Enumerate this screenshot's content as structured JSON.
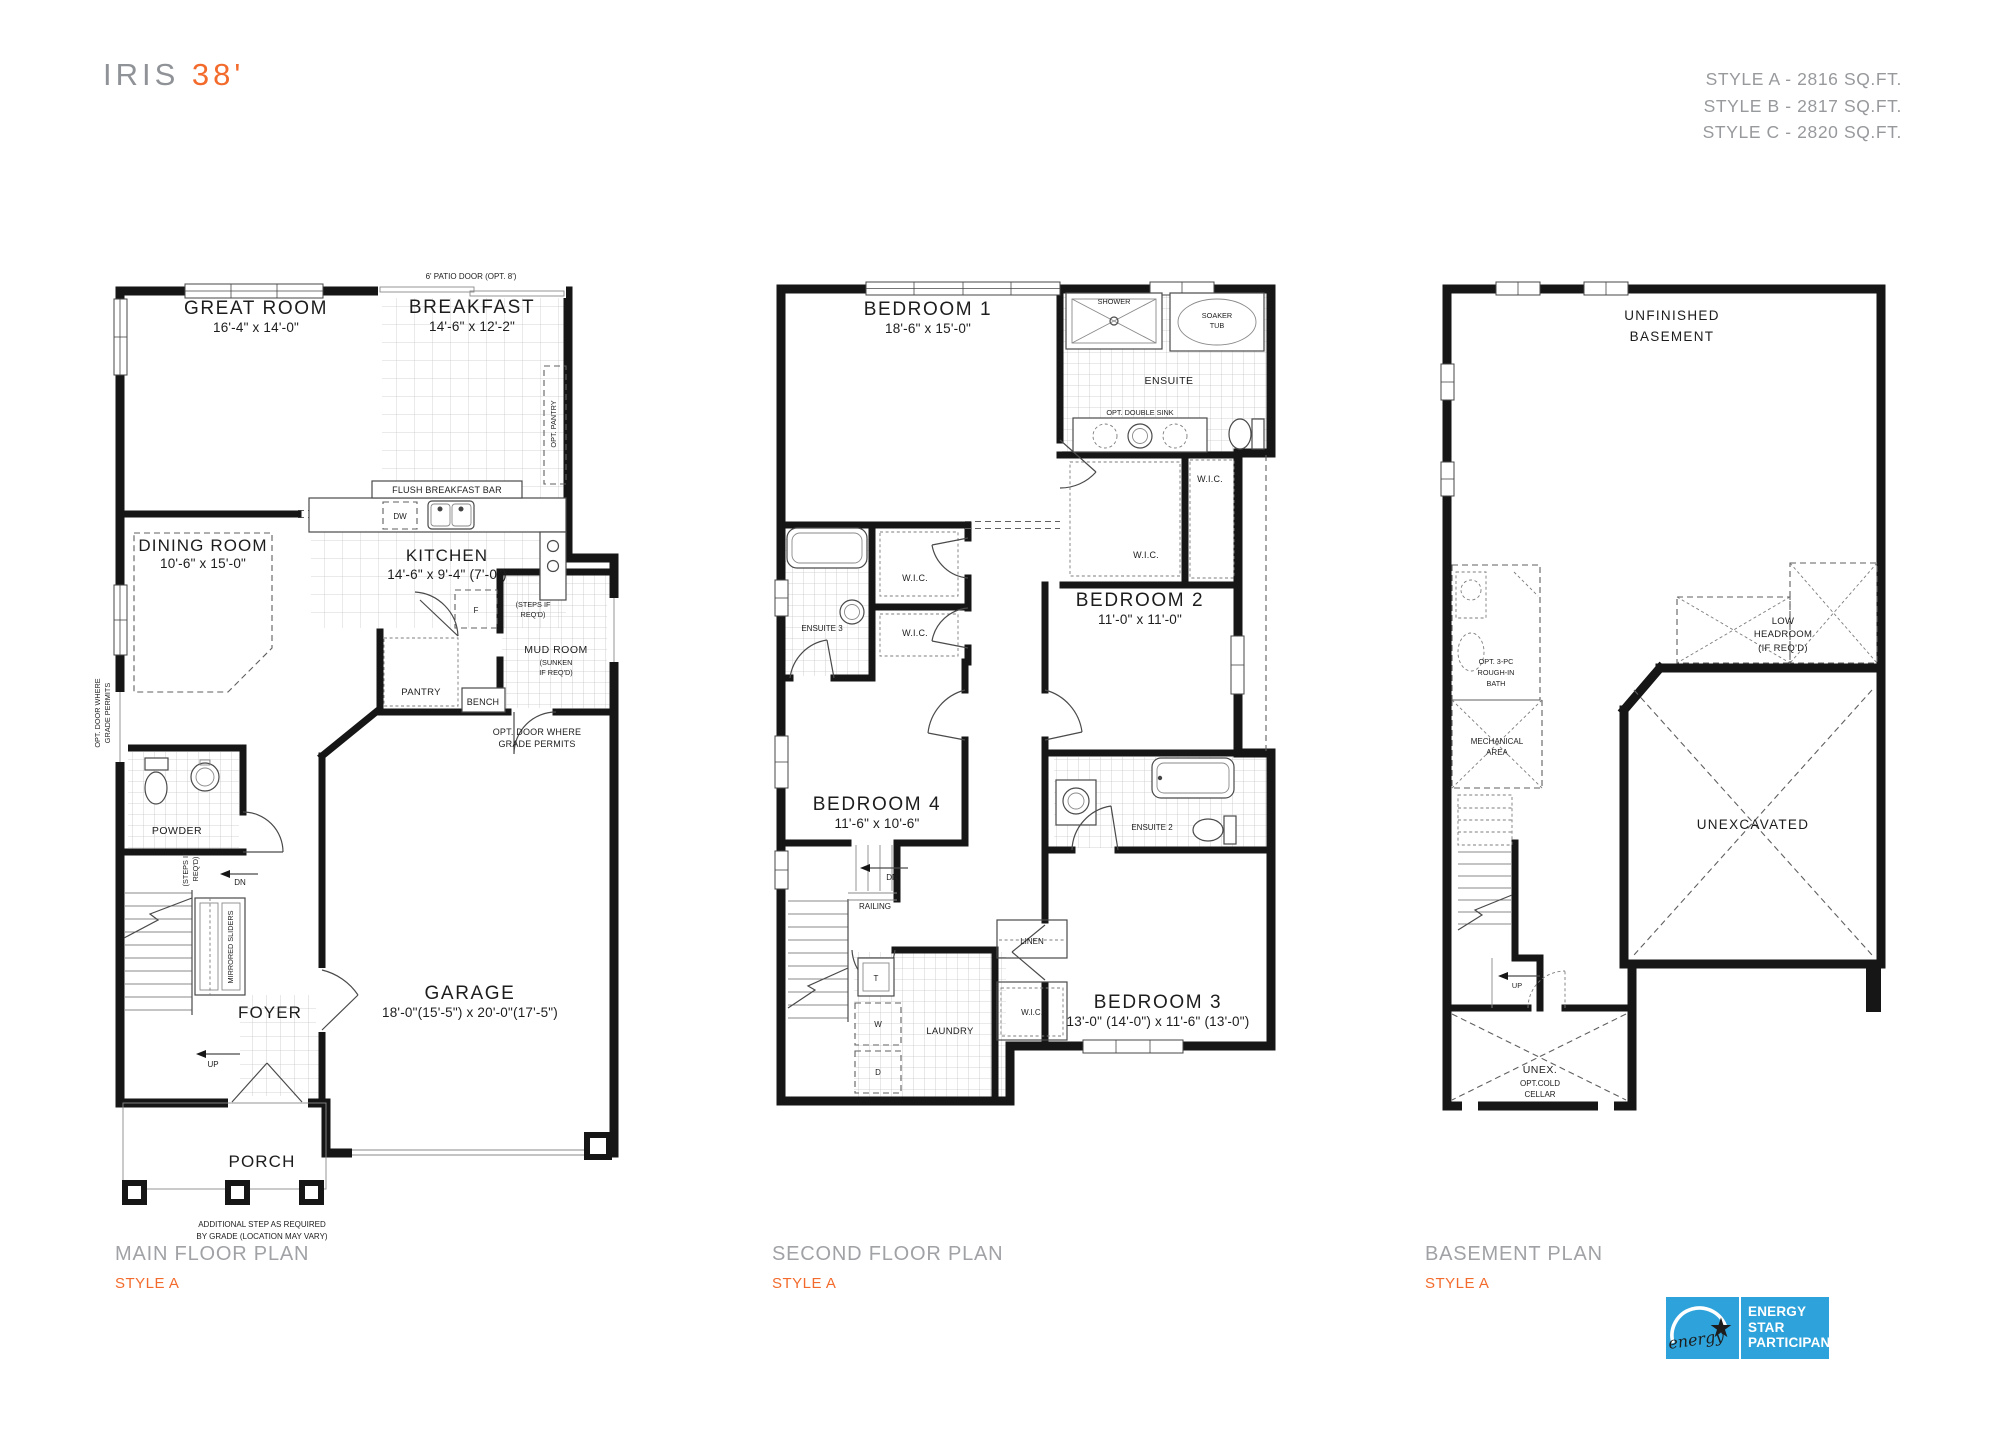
{
  "header": {
    "title": "IRIS",
    "title_size": "38'",
    "styles": [
      "STYLE A - 2816 SQ.FT.",
      "STYLE B - 2817 SQ.FT.",
      "STYLE C - 2820 SQ.FT."
    ]
  },
  "colors": {
    "accent": "#f36b2c",
    "caption_gray": "#a0a2a5",
    "energy_blue": "#2ea3db",
    "wall": "#161616"
  },
  "main_floor": {
    "caption": "MAIN FLOOR PLAN",
    "style": "STYLE A",
    "labels": {
      "patio_door": "6' PATIO DOOR (OPT. 8')",
      "great_room": "GREAT ROOM",
      "great_room_dims": "16'-4\" x 14'-0\"",
      "breakfast": "BREAKFAST",
      "breakfast_dims": "14'-6\" x 12'-2\"",
      "opt_pantry": "OPT. PANTRY",
      "flush_bar": "FLUSH BREAKFAST BAR",
      "dw": "DW",
      "kitchen": "KITCHEN",
      "kitchen_dims": "14'-6\" x 9'-4\" (7'-0\")",
      "dining": "DINING ROOM",
      "dining_dims": "10'-6\" x 15'-0\"",
      "fridge": "F",
      "steps_kitchen_1": "(STEPS IF",
      "steps_kitchen_2": "REQ'D)",
      "mud_room": "MUD ROOM",
      "mud_sunken_1": "(SUNKEN",
      "mud_sunken_2": "IF REQ'D)",
      "pantry": "PANTRY",
      "bench": "BENCH",
      "opt_door_1": "OPT. DOOR WHERE",
      "opt_door_2": "GRADE PERMITS",
      "powder": "POWDER",
      "opt_door_side_1": "OPT. DOOR WHERE",
      "opt_door_side_2": "GRADE PERMITS",
      "steps_stair_1": "(STEPS IF",
      "steps_stair_2": "REQ'D)",
      "dn": "DN",
      "up": "UP",
      "mirrored_sliders": "MIRRORED SLIDERS",
      "foyer": "FOYER",
      "garage": "GARAGE",
      "garage_dims": "18'-0\"(15'-5\") x 20'-0\"(17'-5\")",
      "porch": "PORCH",
      "step_note_1": "ADDITIONAL STEP AS REQUIRED",
      "step_note_2": "BY GRADE (LOCATION MAY VARY)"
    }
  },
  "second_floor": {
    "caption": "SECOND FLOOR PLAN",
    "style": "STYLE A",
    "labels": {
      "bedroom1": "BEDROOM 1",
      "bedroom1_dims": "18'-6\" x 15'-0\"",
      "shower": "SHOWER",
      "soaker_1": "SOAKER",
      "soaker_2": "TUB",
      "ensuite": "ENSUITE",
      "opt_double_sink": "OPT. DOUBLE SINK",
      "wic_a": "W.I.C.",
      "wic_b": "W.I.C.",
      "wic_c": "W.I.C.",
      "wic_d": "W.I.C.",
      "wic_e": "W.I.C.",
      "ensuite3": "ENSUITE 3",
      "bedroom2": "BEDROOM 2",
      "bedroom2_dims": "11'-0\" x 11'-0\"",
      "bedroom4": "BEDROOM 4",
      "bedroom4_dims": "11'-6\" x 10'-6\"",
      "dn": "DN",
      "railing": "RAILING",
      "linen": "LINEN",
      "t": "T",
      "w": "W",
      "d": "D",
      "laundry": "LAUNDRY",
      "ensuite2": "ENSUITE 2",
      "bedroom3": "BEDROOM 3",
      "bedroom3_dims": "13'-0\" (14'-0\") x 11'-6\" (13'-0\")"
    }
  },
  "basement": {
    "caption": "BASEMENT PLAN",
    "style": "STYLE A",
    "labels": {
      "unfinished_1": "UNFINISHED",
      "unfinished_2": "BASEMENT",
      "low_1": "LOW",
      "low_2": "HEADROOM",
      "low_3": "(IF REQ'D)",
      "bath_1": "OPT. 3-PC",
      "bath_2": "ROUGH-IN",
      "bath_3": "BATH",
      "mech_1": "MECHANICAL",
      "mech_2": "AREA",
      "unexcavated": "UNEXCAVATED",
      "up": "UP",
      "unex_1": "UNEX.",
      "unex_2": "OPT.COLD",
      "unex_3": "CELLAR"
    }
  },
  "energy_star": {
    "script": "energy",
    "star_glyph": "★",
    "line1": "ENERGY",
    "line2": "STAR",
    "line3": "PARTICIPANT"
  }
}
